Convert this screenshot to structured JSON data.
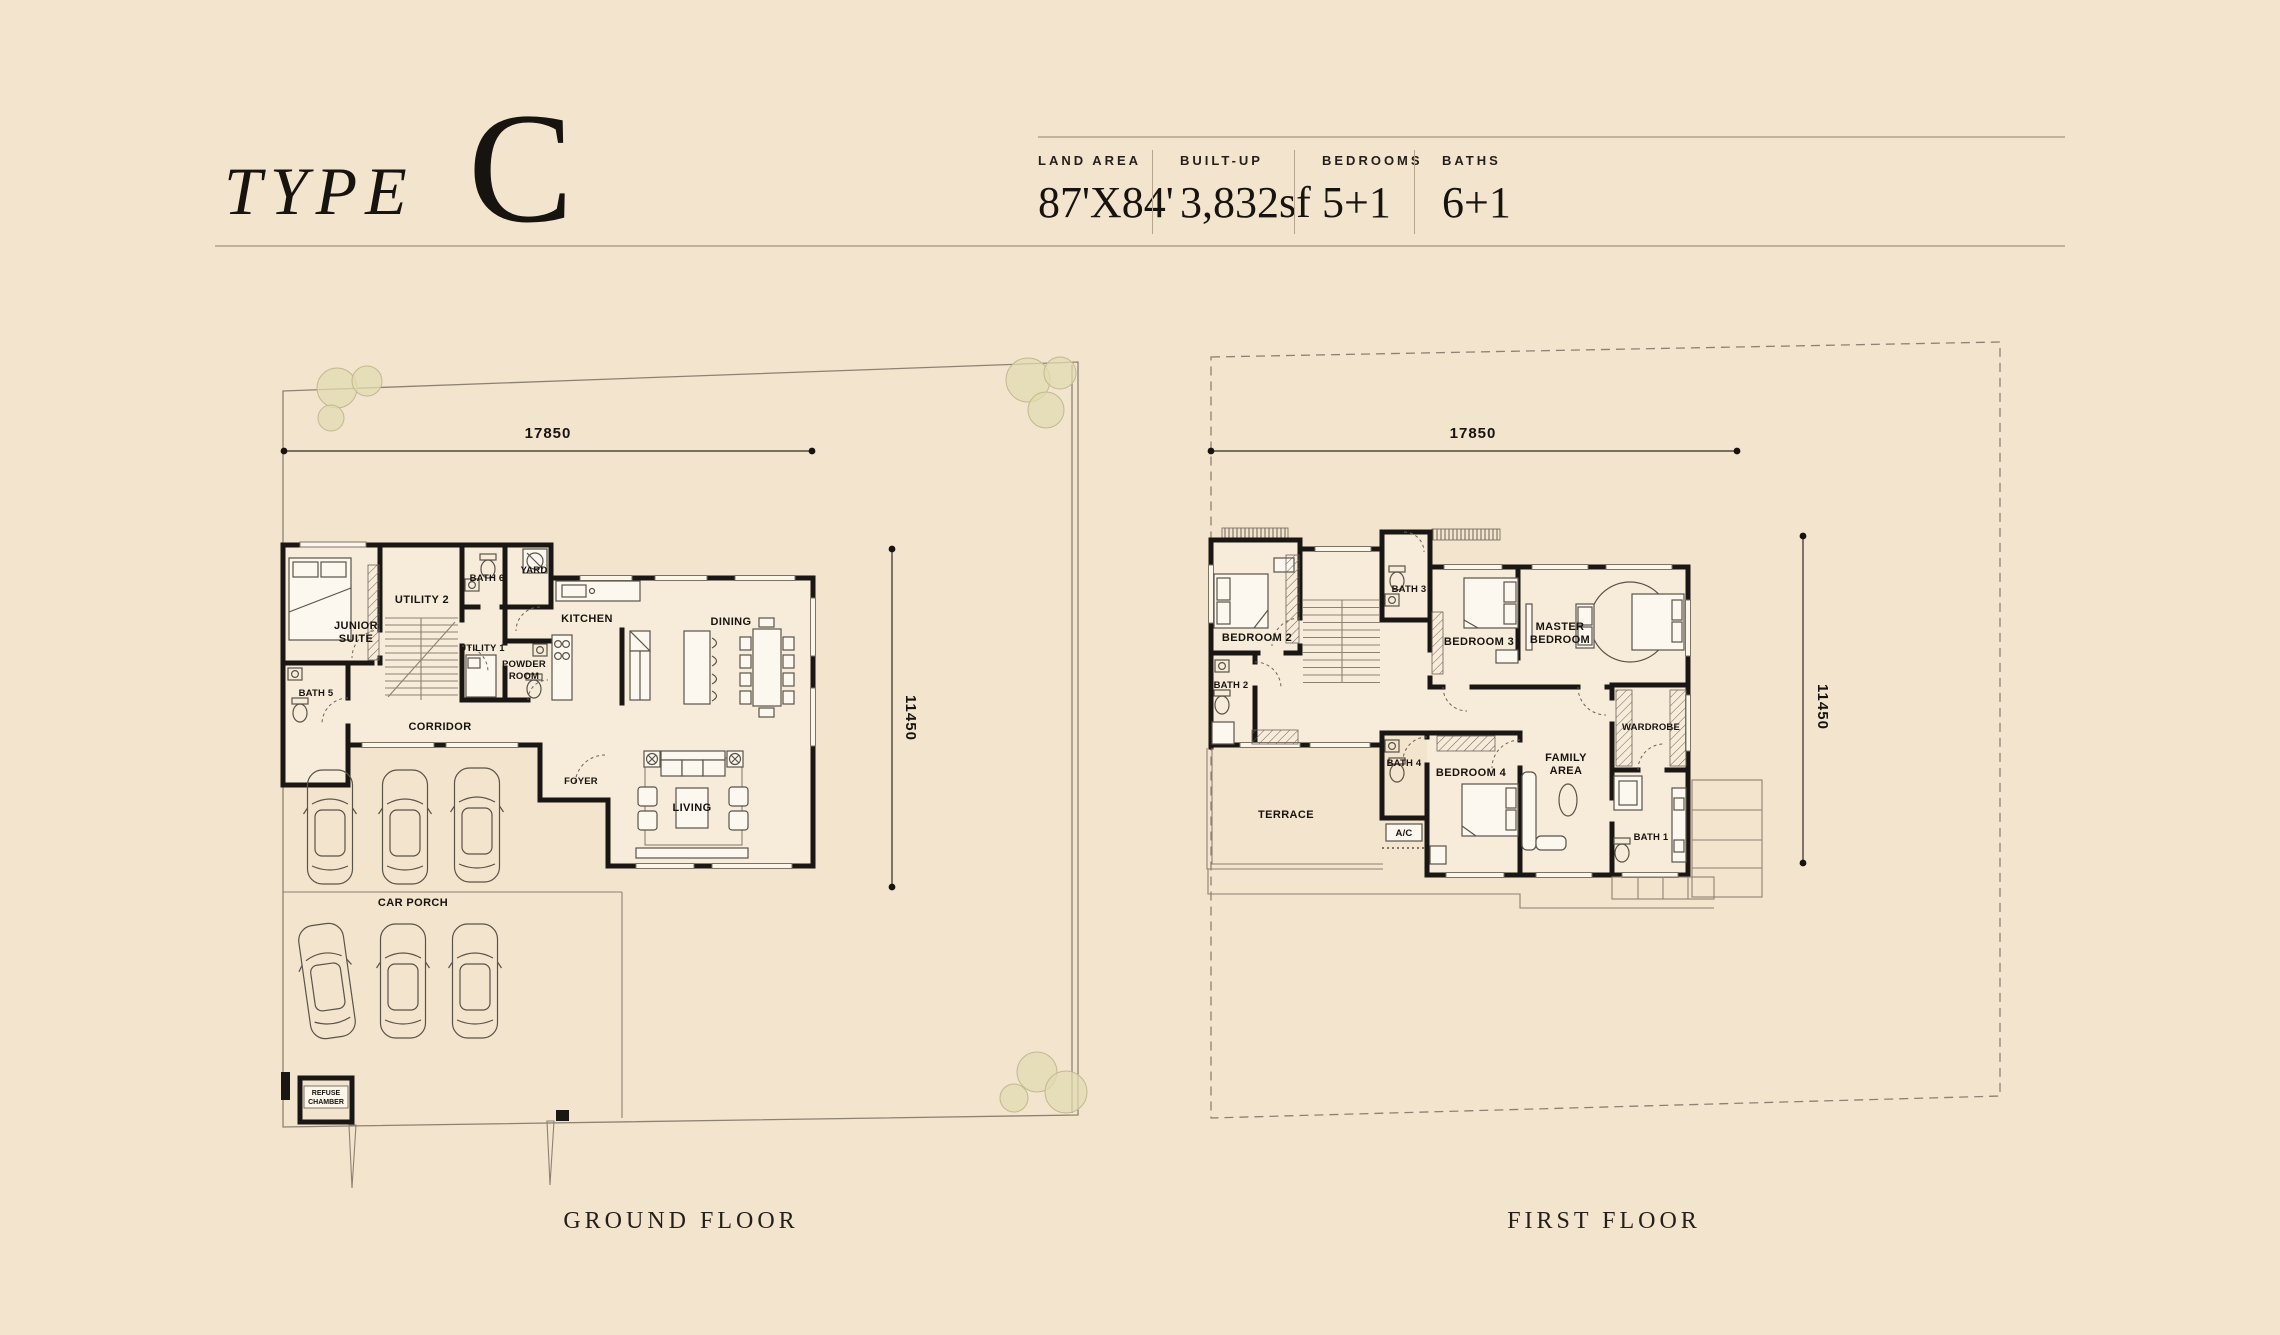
{
  "header": {
    "type_label": "TYPE",
    "type_letter": "C",
    "stats": [
      {
        "label": "LAND AREA",
        "value": "87'X84'"
      },
      {
        "label": "BUILT-UP",
        "value": "3,832sf"
      },
      {
        "label": "BEDROOMS",
        "value": "5+1"
      },
      {
        "label": "BATHS",
        "value": "6+1"
      }
    ]
  },
  "ground_floor": {
    "caption": "GROUND FLOOR",
    "dim_width": "17850",
    "dim_depth": "11450",
    "rooms": {
      "junior_suite": [
        "JUNIOR",
        "SUITE"
      ],
      "utility_2": "UTILITY 2",
      "bath_6": "BATH 6",
      "yard": "YARD",
      "utility_1": "UTILITY 1",
      "kitchen": "KITCHEN",
      "dining": "DINING",
      "powder_room": [
        "POWDER",
        "ROOM"
      ],
      "bath_5": "BATH 5",
      "corridor": "CORRIDOR",
      "foyer": "FOYER",
      "living": "LIVING",
      "car_porch": "CAR PORCH",
      "refuse_chamber": [
        "REFUSE",
        "CHAMBER"
      ]
    }
  },
  "first_floor": {
    "caption": "FIRST FLOOR",
    "dim_width": "17850",
    "dim_depth": "11450",
    "rooms": {
      "bedroom_2": "BEDROOM 2",
      "bath_3": "BATH 3",
      "bedroom_3": "BEDROOM 3",
      "master_bedroom": [
        "MASTER",
        "BEDROOM"
      ],
      "bath_2": "BATH 2",
      "wardrobe": "WARDROBE",
      "terrace": "TERRACE",
      "bath_4": "BATH 4",
      "ac": "A/C",
      "bedroom_4": "BEDROOM 4",
      "family_area": [
        "FAMILY",
        "AREA"
      ],
      "bath_1": "BATH 1"
    }
  }
}
